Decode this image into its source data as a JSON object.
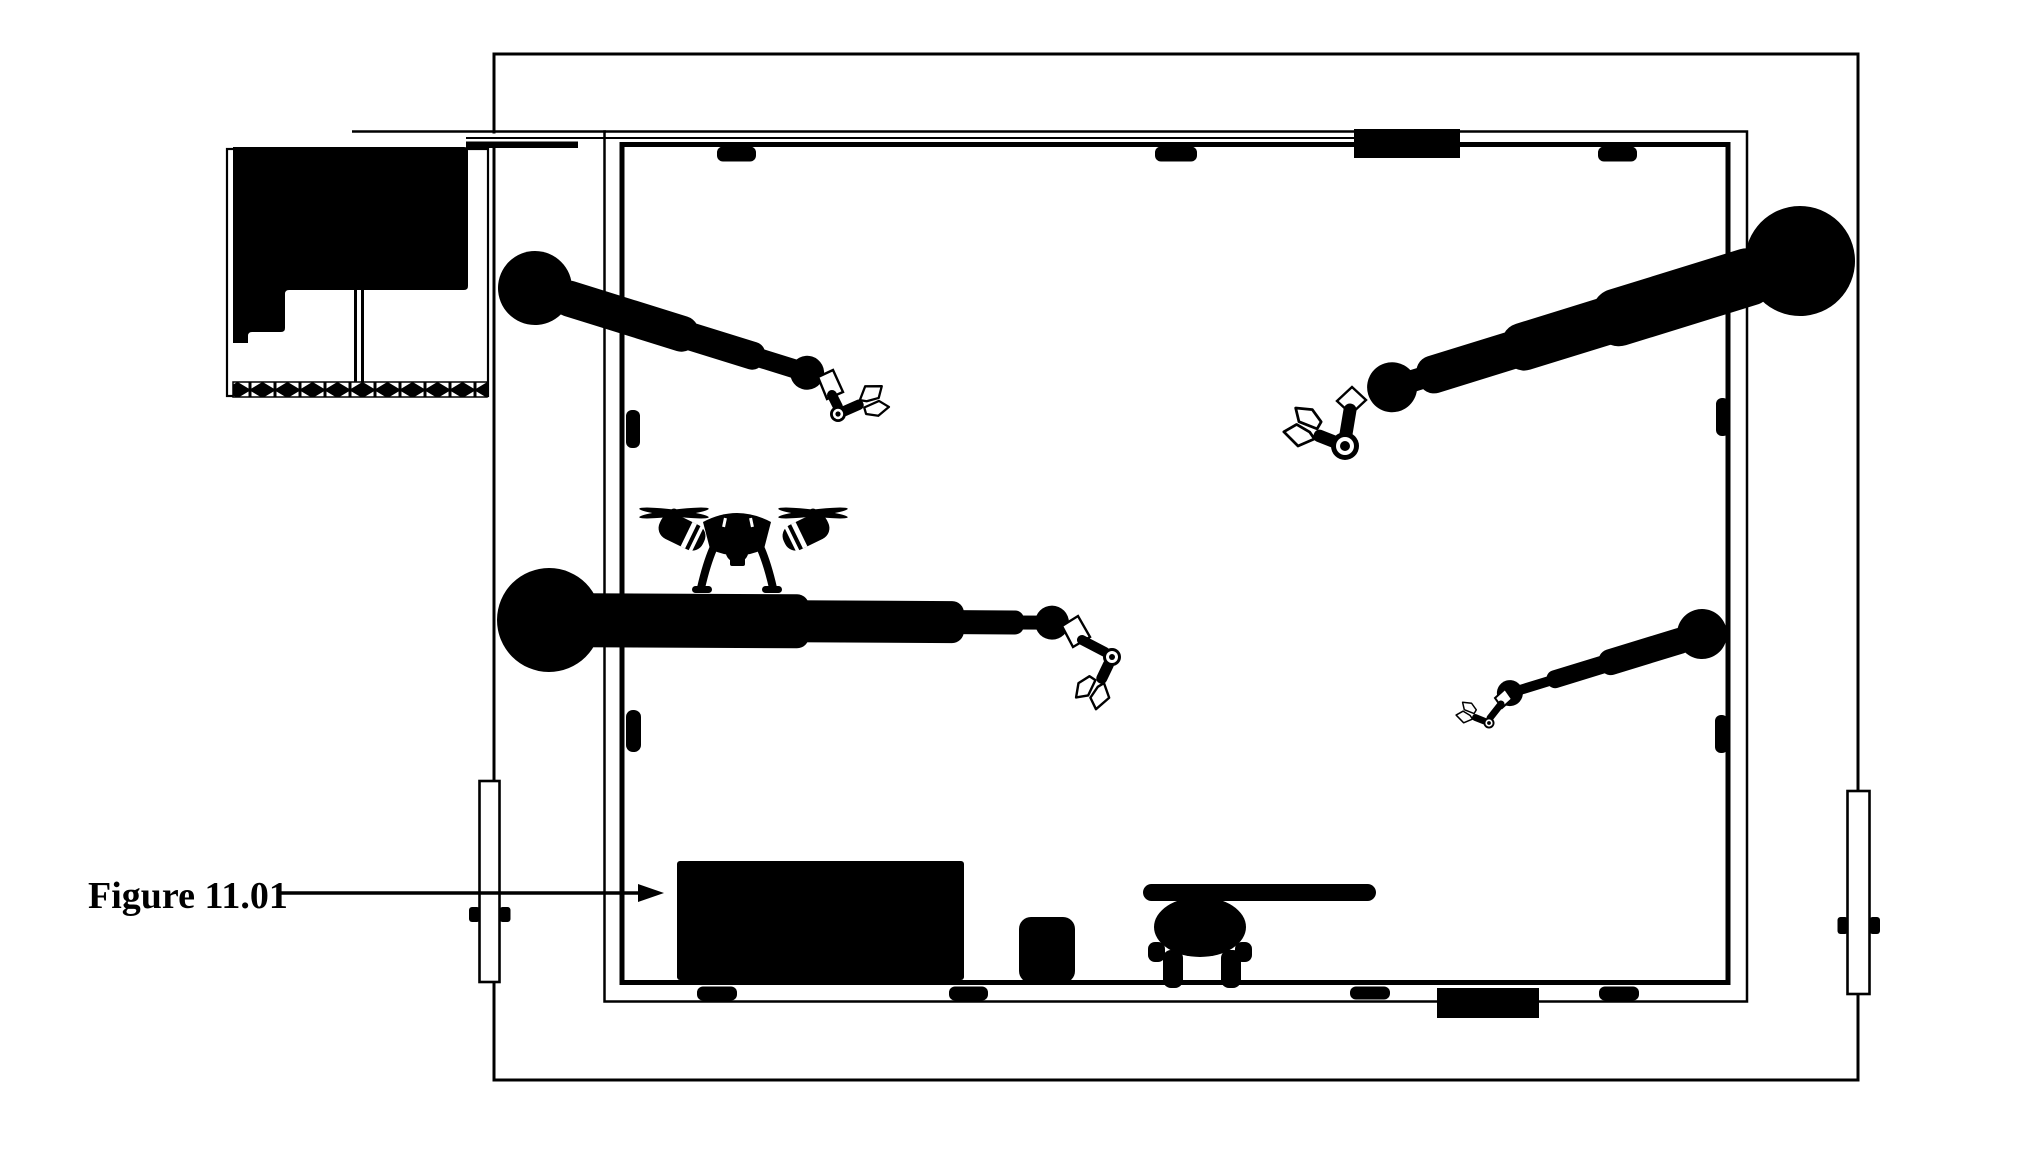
{
  "figure": {
    "label": "Figure 11.01"
  },
  "colors": {
    "ink": "#000000",
    "paper": "#ffffff"
  },
  "scene": {
    "type": "floor-plan-diagram",
    "description": "Plan view of a rectangular robotics laboratory room with double walls, four articulated robotic arms with grippers, a quadcopter drone, a workbench, a stool, a chair with table, an equipment cabinet alcove with hatched strip, two sliding doors, wall sensors and wall vents",
    "components": [
      {
        "name": "equipment-cabinet",
        "count": 1
      },
      {
        "name": "robotic-arm",
        "count": 4
      },
      {
        "name": "drone",
        "count": 1
      },
      {
        "name": "workbench",
        "count": 1
      },
      {
        "name": "stool",
        "count": 1
      },
      {
        "name": "chair-with-table",
        "count": 1
      },
      {
        "name": "sliding-door",
        "count": 2
      },
      {
        "name": "wall-sensor",
        "count": 11
      },
      {
        "name": "wall-vent",
        "count": 2
      }
    ]
  }
}
